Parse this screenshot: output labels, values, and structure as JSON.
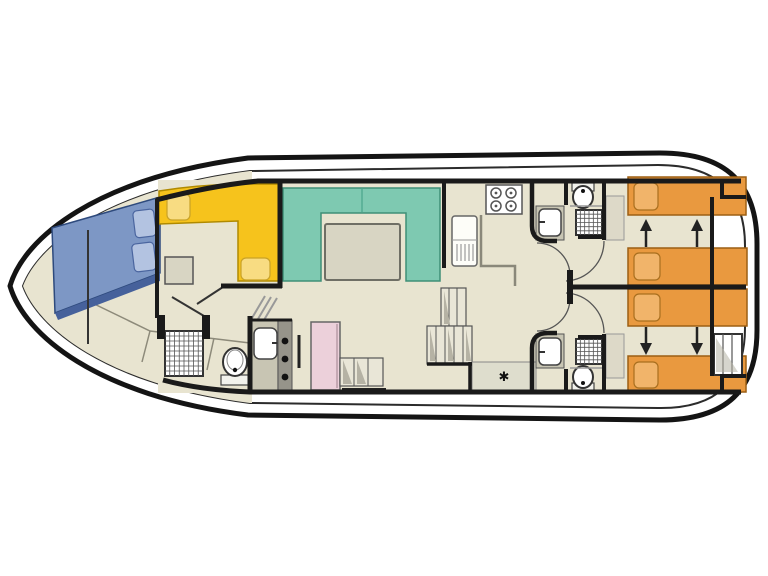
{
  "symbols": {
    "star": "✱"
  },
  "palette": {
    "hull_stroke": "#141414",
    "inner_stroke": "#2b2b2b",
    "wall": "#1a1a1a",
    "floor": "#e8e4d0",
    "white": "#ffffff",
    "blue_bed": "#7d97c5",
    "blue_edge": "#46619b",
    "blue_pillow": "#b3c3e1",
    "yellow_bench": "#f6c31c",
    "yellow_cushion": "#f8dc82",
    "teal_sofa": "#7ec9b1",
    "teal_border": "#3f8f77",
    "table_gray": "#d8d5c3",
    "orange_bed": "#e9993f",
    "orange_border": "#9c5f14",
    "orange_pillow": "#f1b46a",
    "pink_unit": "#ecd0da",
    "gray_unit": "#c8c5b3",
    "dark_strip": "#96948a",
    "step_fill": "#e9e6d7",
    "shade": "#b5b2a4",
    "fixture": "#333333"
  },
  "features": [
    "bow-v-berth",
    "dinette-bench",
    "front-shower-room",
    "saloon-u-sofa",
    "saloon-table",
    "galley-stove",
    "galley-fridge",
    "midship-stairs",
    "heater-star",
    "aft-cabin-port",
    "aft-cabin-starboard",
    "ensuite-shower-top",
    "ensuite-shower-bottom",
    "stern-ladder",
    "sliding-bed-arrows"
  ]
}
